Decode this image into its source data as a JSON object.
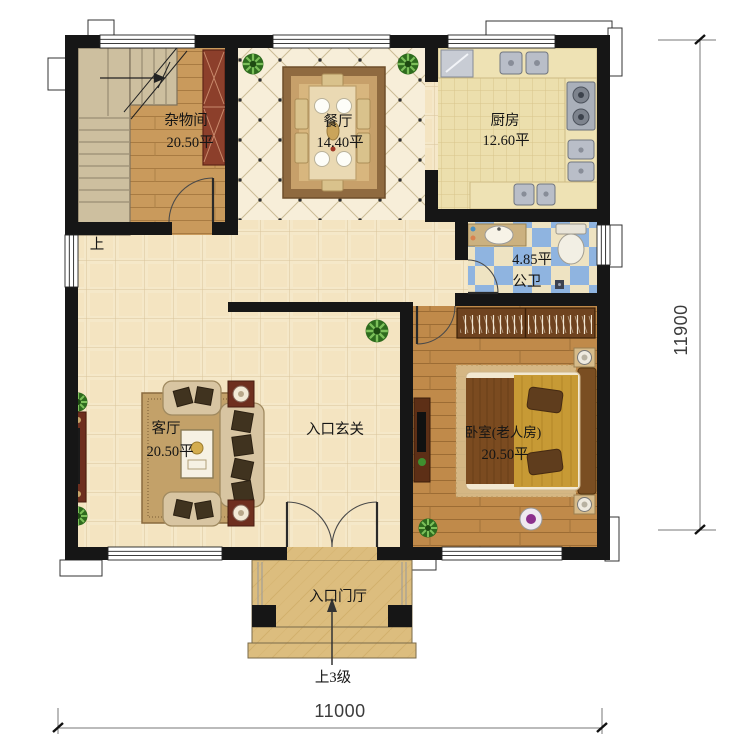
{
  "plan": {
    "rooms": {
      "storage": {
        "name": "杂物间",
        "area": "20.50平"
      },
      "dining": {
        "name": "餐厅",
        "area": "14.40平"
      },
      "kitchen": {
        "name": "厨房",
        "area": "12.60平"
      },
      "bathroom": {
        "name": "公卫",
        "area": "4.85平"
      },
      "living": {
        "name": "客厅",
        "area": "20.50平"
      },
      "hall": {
        "name": "入口玄关"
      },
      "bedroom": {
        "name": "卧室(老人房)",
        "area": "20.50平"
      },
      "porch": {
        "name": "入口门厅"
      }
    },
    "annotations": {
      "stair_up": "上",
      "entry_steps": "上3级"
    },
    "dimensions": {
      "bottom_width": "11000",
      "right_height": "11900"
    },
    "colors": {
      "wall": "#161616",
      "tile": "#f5e8c9",
      "wood": "#c08a4a",
      "bath_blue": "#8fb4e0",
      "marble": "#dcbd7e"
    }
  }
}
